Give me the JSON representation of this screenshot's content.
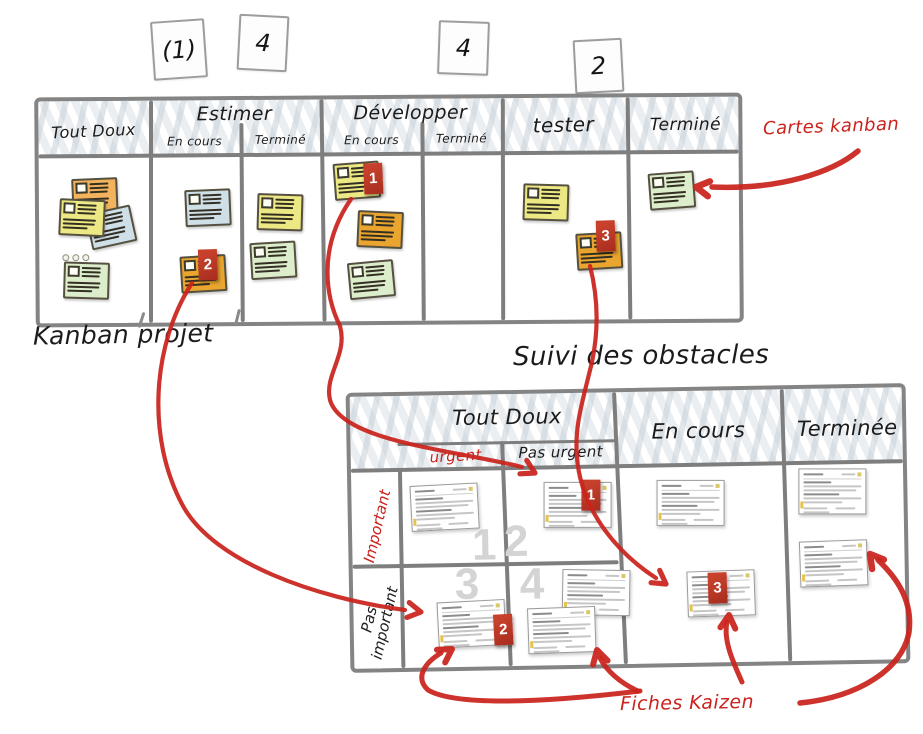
{
  "colors": {
    "ink_red": "#c9231c",
    "badge_red": "#b93826",
    "line_gray": "#7e7e7e",
    "number_gray": "#d4d4d4",
    "scribble_gray": "#c6d0d8",
    "sticky_orange": "#f2b35c",
    "sticky_amber": "#eaa52e",
    "sticky_yellow": "#ece884",
    "sticky_blue": "#cfdfe8",
    "sticky_green": "#dcedcc"
  },
  "board1": {
    "caption": "Kanban projet",
    "wip_cards": [
      {
        "value": "(1)",
        "x": 152,
        "y": 20,
        "w": 50,
        "h": 55,
        "rot": -4
      },
      {
        "value": "4",
        "x": 238,
        "y": 15,
        "w": 46,
        "h": 52,
        "rot": 3
      },
      {
        "value": "4",
        "x": 438,
        "y": 21,
        "w": 47,
        "h": 50,
        "rot": 2
      },
      {
        "value": "2",
        "x": 574,
        "y": 39,
        "w": 45,
        "h": 50,
        "rot": -3
      }
    ],
    "headers": {
      "tout_doux": "Tout Doux",
      "estimer": "Estimer",
      "estimer_sub1": "En cours",
      "estimer_sub2": "Terminé",
      "developper": "Développer",
      "developper_sub1": "En cours",
      "developper_sub2": "Terminé",
      "tester": "tester",
      "termine": "Terminé"
    },
    "stickies": [
      {
        "column": "tout-doux",
        "color": "orange",
        "x": 33,
        "y": 77,
        "rot": -2
      },
      {
        "column": "tout-doux",
        "color": "blue",
        "x": 49,
        "y": 108,
        "rot": -12
      },
      {
        "column": "tout-doux",
        "color": "yellow",
        "x": 20,
        "y": 98,
        "rot": 3
      },
      {
        "column": "tout-doux",
        "color": "green",
        "x": 24,
        "y": 161,
        "rot": 2
      },
      {
        "column": "estimer-en-cours",
        "color": "blue",
        "x": 146,
        "y": 89,
        "rot": -2
      },
      {
        "column": "estimer-en-cours",
        "color": "amber",
        "x": 141,
        "y": 155,
        "rot": -3,
        "badge": "2",
        "bx": 18,
        "by": -6
      },
      {
        "column": "estimer-termine",
        "color": "yellow",
        "x": 218,
        "y": 94,
        "rot": 2
      },
      {
        "column": "estimer-termine",
        "color": "green",
        "x": 211,
        "y": 142,
        "rot": -3
      },
      {
        "column": "developper-en-cours",
        "color": "yellow",
        "x": 295,
        "y": 63,
        "rot": -4,
        "badge": "1",
        "bx": 30,
        "by": 1
      },
      {
        "column": "developper-en-cours",
        "color": "amber",
        "x": 318,
        "y": 112,
        "rot": 3
      },
      {
        "column": "developper-en-cours",
        "color": "green",
        "x": 309,
        "y": 162,
        "rot": -5
      },
      {
        "column": "tester",
        "color": "yellow",
        "x": 484,
        "y": 86,
        "rot": 2
      },
      {
        "column": "tester",
        "color": "amber",
        "x": 537,
        "y": 135,
        "rot": -3,
        "badge": "3",
        "bx": 20,
        "by": -12
      },
      {
        "column": "termine",
        "color": "green",
        "x": 610,
        "y": 75,
        "rot": -4
      }
    ],
    "ellipsis": {
      "x": 23,
      "y": 153
    }
  },
  "board2": {
    "title": "Suivi des obstacles",
    "headers": {
      "tout_doux": "Tout Doux",
      "urgent": "urgent",
      "pas_urgent": "Pas urgent",
      "en_cours": "En cours",
      "terminee": "Terminée"
    },
    "row_labels": {
      "important": "Important",
      "pas_important_1": "Pas",
      "pas_important_2": "important"
    },
    "quadrant_numbers": [
      {
        "value": "1",
        "x": 132,
        "y": 151
      },
      {
        "value": "2",
        "x": 164,
        "y": 148
      },
      {
        "value": "3",
        "x": 114,
        "y": 190
      },
      {
        "value": "4",
        "x": 179,
        "y": 191
      }
    ],
    "kaizen_cards": [
      {
        "zone": "urgent-important",
        "x": 59,
        "y": 89,
        "rot": -2
      },
      {
        "zone": "pas-urgent-important",
        "x": 192,
        "y": 89,
        "rot": 1,
        "badge": "1",
        "bx": 38,
        "by": -2
      },
      {
        "zone": "urgent-pas-important",
        "x": 84,
        "y": 206,
        "rot": -2,
        "badge": "2",
        "bx": 56,
        "by": 14
      },
      {
        "zone": "pas-urgent-pas-important",
        "x": 209,
        "y": 177,
        "rot": 2
      },
      {
        "zone": "pas-urgent-pas-important",
        "x": 174,
        "y": 214,
        "rot": -1
      },
      {
        "zone": "en-cours",
        "x": 305,
        "y": 89,
        "rot": 1
      },
      {
        "zone": "en-cours",
        "x": 334,
        "y": 180,
        "rot": -1,
        "badge": "3",
        "bx": 21,
        "by": 2
      },
      {
        "zone": "terminee",
        "x": 447,
        "y": 80,
        "rot": 1
      },
      {
        "zone": "terminee",
        "x": 447,
        "y": 152,
        "rot": -1
      }
    ]
  },
  "annotations": {
    "cartes_kanban": "Cartes kanban",
    "fiches_kaizen": "Fiches Kaizen"
  }
}
